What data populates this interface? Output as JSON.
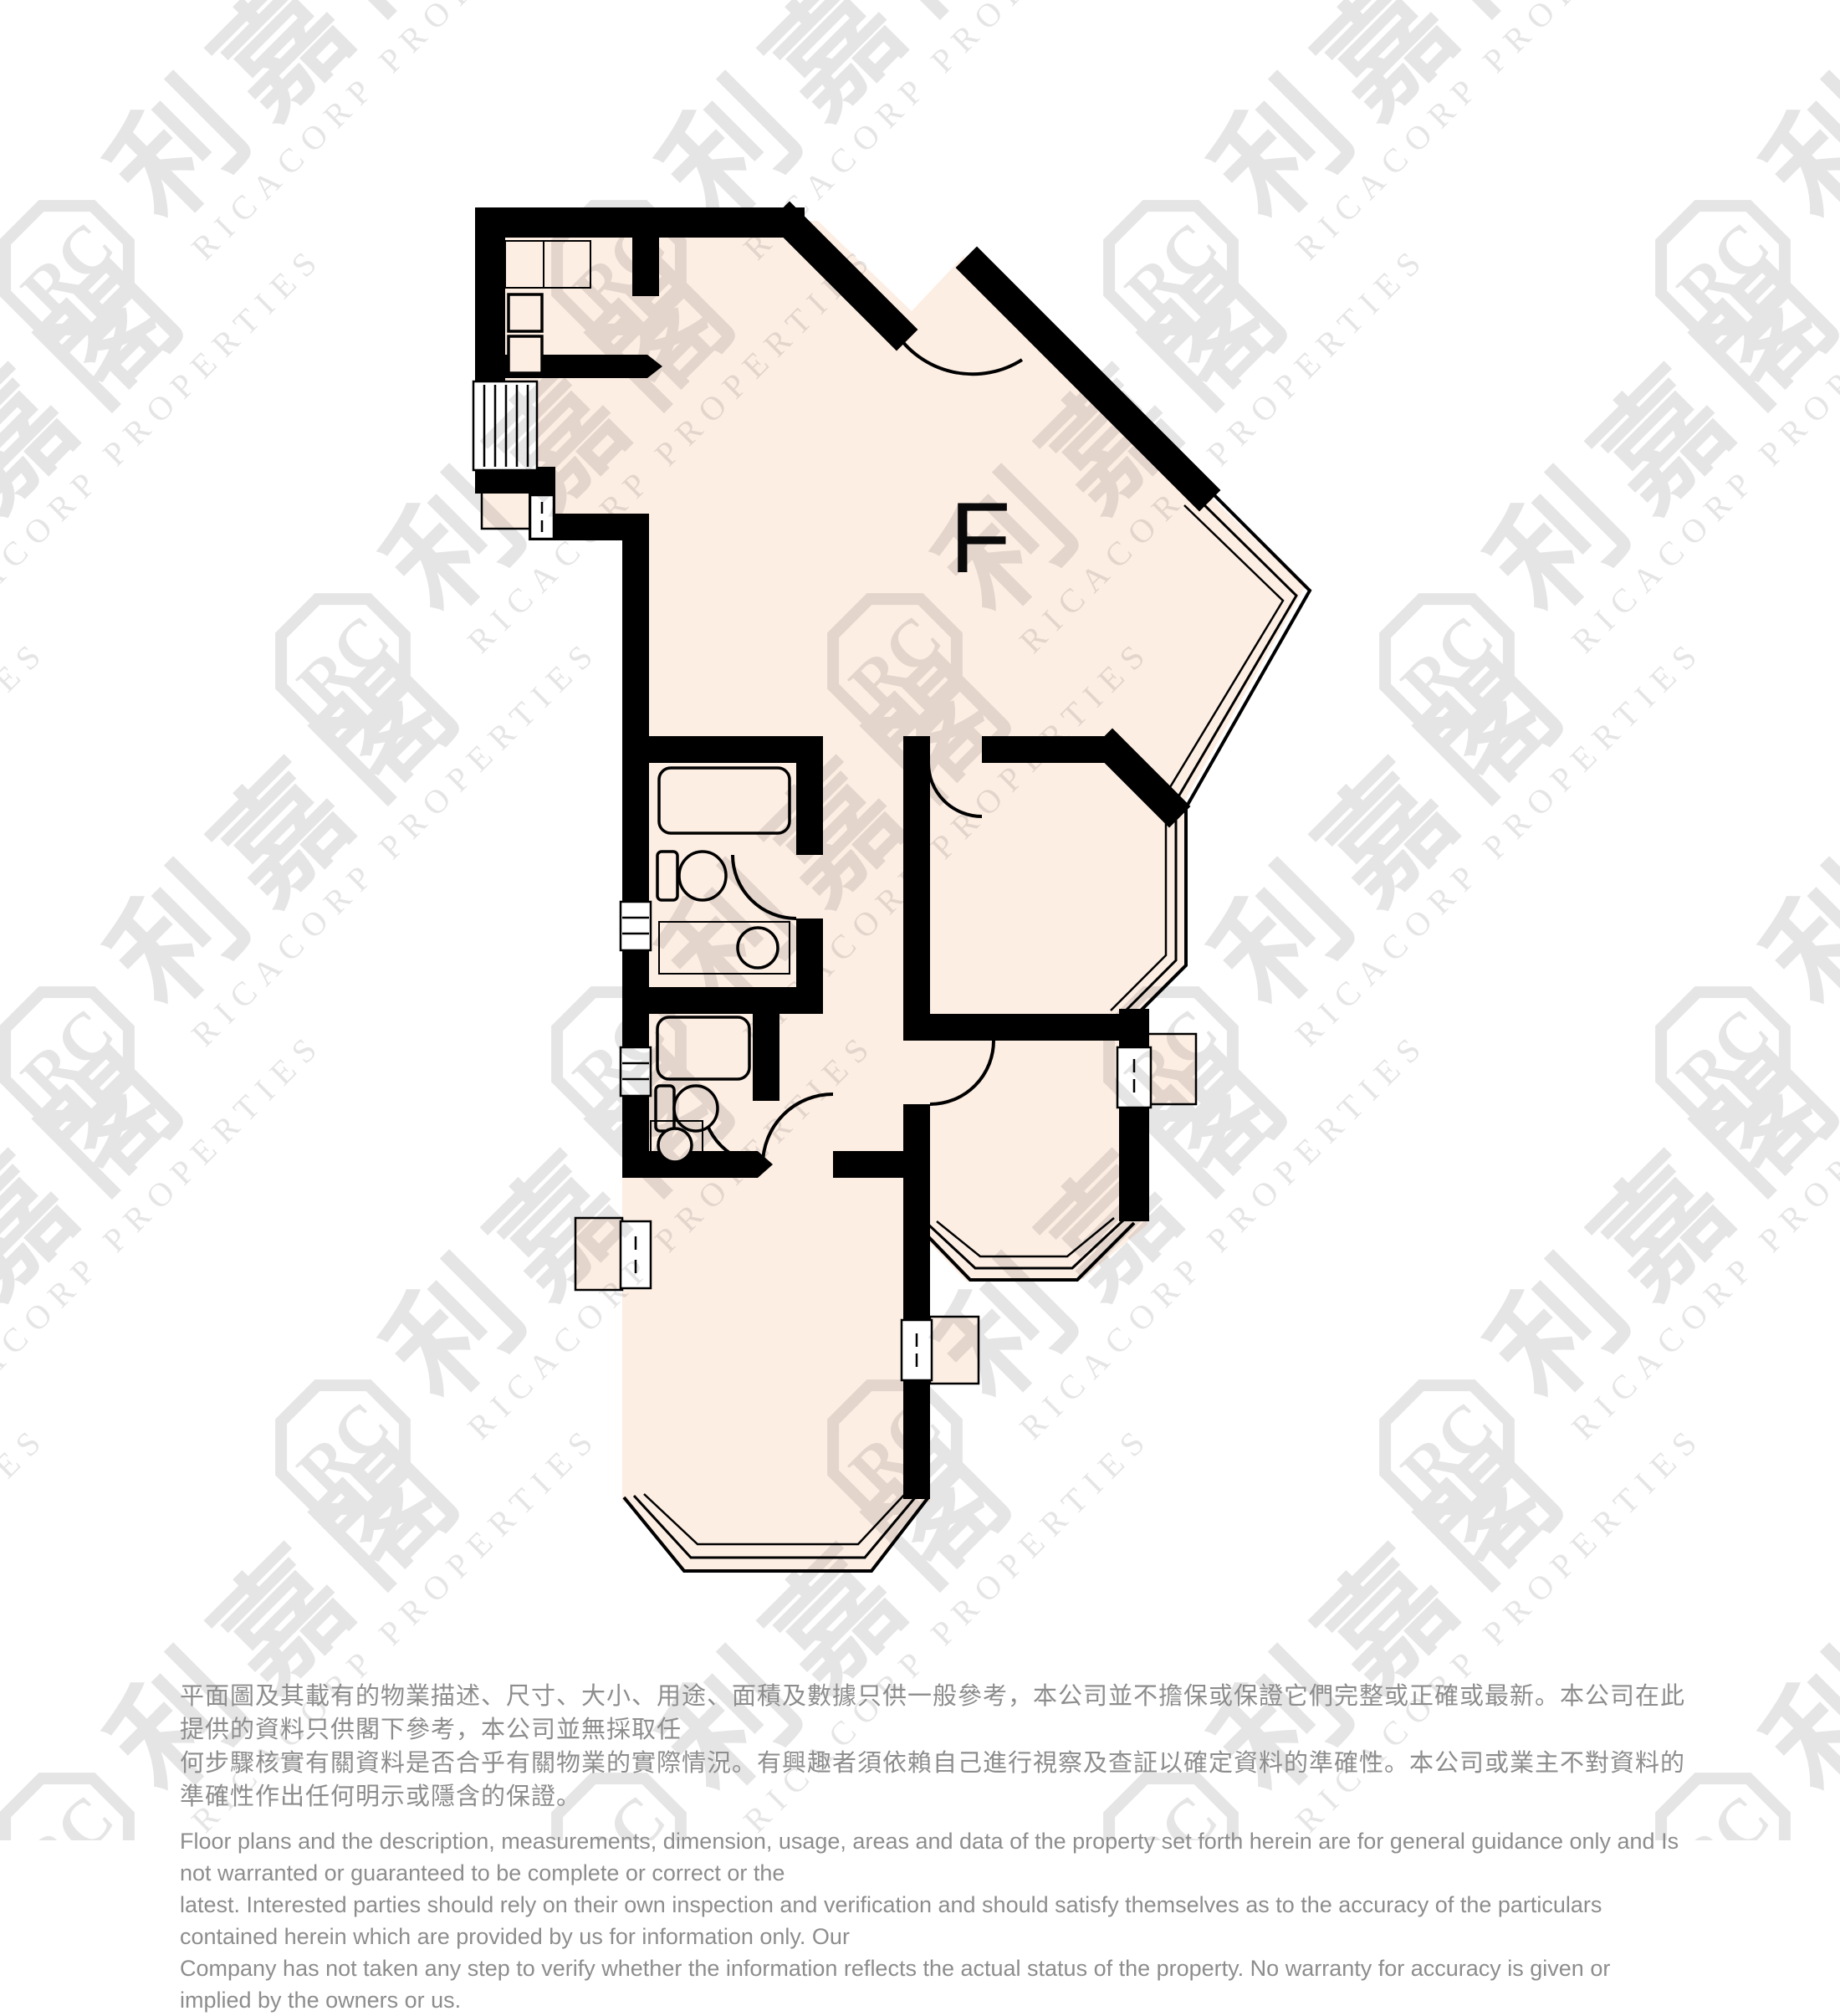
{
  "page": {
    "background": "#ffffff"
  },
  "unit": {
    "label": "F"
  },
  "watermark": {
    "monogram": "RC",
    "name_zh": "利嘉閣",
    "name_en": "RICACORP PROPERTIES",
    "color": "#e4e4e4"
  },
  "palette": {
    "floor": "#fdeee3",
    "wall": "#000000",
    "disclaimer_text": "#8d8d8d"
  },
  "fixtures": [
    "kitchen-counter",
    "stove-top",
    "kitchen-appliance",
    "louver-window",
    "bathtub",
    "toilet",
    "wash-basin",
    "vanity-counter",
    "bay-window",
    "corner-window",
    "ac-platform",
    "ac-window",
    "door-swing"
  ],
  "disclaimer": {
    "zh_lines": [
      "平面圖及其載有的物業描述、尺寸、大小、用途、面積及數據只供一般參考，本公司並不擔保或保證它們完整或正確或最新。本公司在此提供的資料只供閣下參考，本公司並無採取任",
      "何步驟核實有關資料是否合乎有關物業的實際情況。有興趣者須依賴自己進行視察及查証以確定資料的準確性。本公司或業主不對資料的準確性作出任何明示或隱含的保證。"
    ],
    "en_lines": [
      "Floor plans and the description, measurements, dimension, usage, areas and data of the property set forth herein are for general guidance only and Is not warranted or guaranteed to be complete or correct or the",
      "latest. Interested parties should rely on their own inspection and verification and should satisfy themselves as to the accuracy of the particulars contained herein which are provided by us for information only.  Our",
      "Company has not taken any step to verify whether the information reflects the actual status of the property.  No warranty for accuracy is given or implied by the owners or us."
    ]
  }
}
